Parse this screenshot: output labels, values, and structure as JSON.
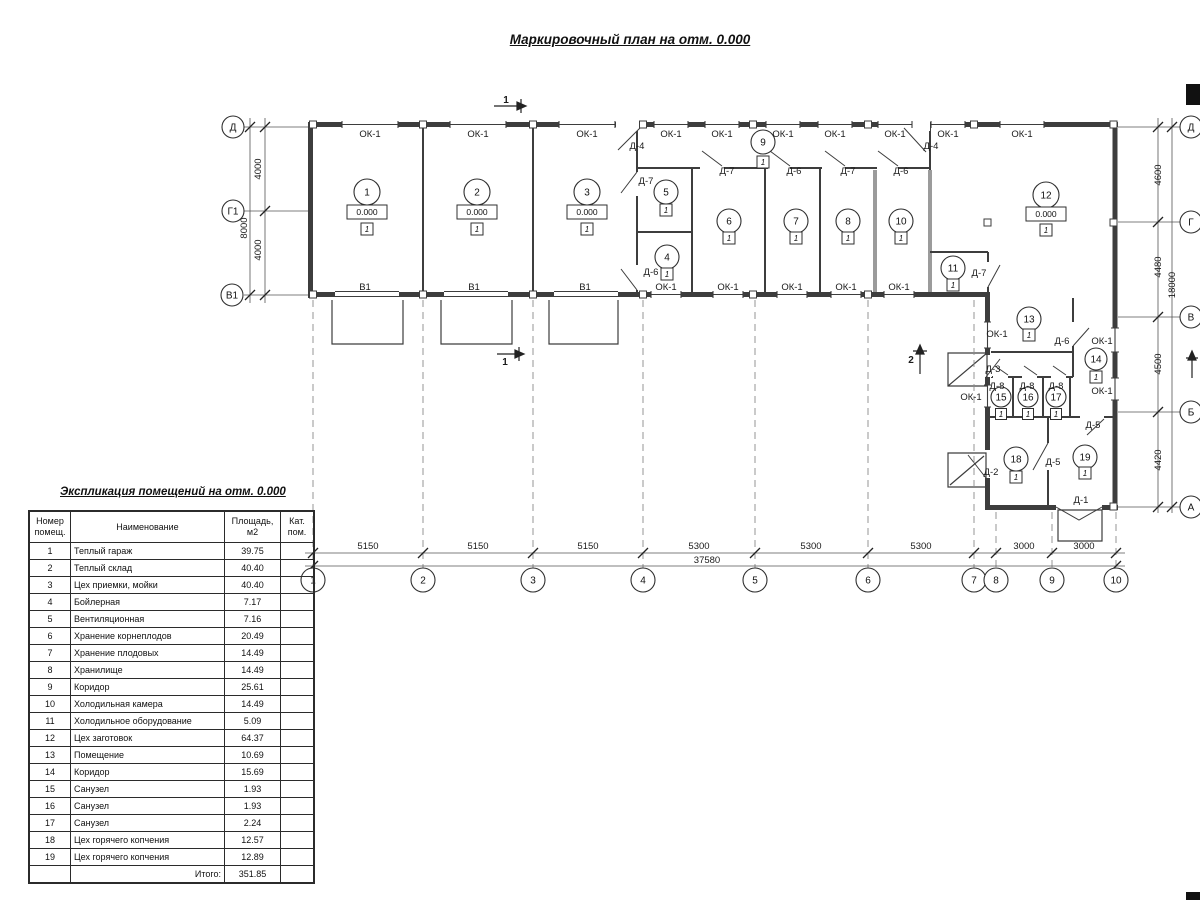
{
  "title": "Маркировочный план на отм. 0.000",
  "explication": {
    "title": "Экспликация помещений на отм. 0.000",
    "headers": [
      "Номер\nпомещ.",
      "Наименование",
      "Площадь,\nм2",
      "Кат.\nпом."
    ],
    "rows": [
      [
        "1",
        "Теплый гараж",
        "39.75",
        ""
      ],
      [
        "2",
        "Теплый склад",
        "40.40",
        ""
      ],
      [
        "3",
        "Цех приемки, мойки",
        "40.40",
        ""
      ],
      [
        "4",
        "Бойлерная",
        "7.17",
        ""
      ],
      [
        "5",
        "Вентиляционная",
        "7.16",
        ""
      ],
      [
        "6",
        "Хранение корнеплодов",
        "20.49",
        ""
      ],
      [
        "7",
        "Хранение плодовых",
        "14.49",
        ""
      ],
      [
        "8",
        "Хранилище",
        "14.49",
        ""
      ],
      [
        "9",
        "Коридор",
        "25.61",
        ""
      ],
      [
        "10",
        "Холодильная камера",
        "14.49",
        ""
      ],
      [
        "11",
        "Холодильное оборудование",
        "5.09",
        ""
      ],
      [
        "12",
        "Цех заготовок",
        "64.37",
        ""
      ],
      [
        "13",
        "Помещение",
        "10.69",
        ""
      ],
      [
        "14",
        "Коридор",
        "15.69",
        ""
      ],
      [
        "15",
        "Санузел",
        "1.93",
        ""
      ],
      [
        "16",
        "Санузел",
        "1.93",
        ""
      ],
      [
        "17",
        "Санузел",
        "2.24",
        ""
      ],
      [
        "18",
        "Цех горячего копчения",
        "12.57",
        ""
      ],
      [
        "19",
        "Цех горячего копчения",
        "12.89",
        ""
      ]
    ],
    "total_label": "Итого:",
    "total_value": "351.85"
  },
  "plan": {
    "labels": [
      {
        "t": "ОК-1",
        "x": 370,
        "y": 137,
        "n": "window-mark"
      },
      {
        "t": "ОК-1",
        "x": 478,
        "y": 137,
        "n": "window-mark"
      },
      {
        "t": "ОК-1",
        "x": 587,
        "y": 137,
        "n": "window-mark"
      },
      {
        "t": "ОК-1",
        "x": 671,
        "y": 137,
        "n": "window-mark"
      },
      {
        "t": "ОК-1",
        "x": 722,
        "y": 137,
        "n": "window-mark"
      },
      {
        "t": "ОК-1",
        "x": 783,
        "y": 137,
        "n": "window-mark"
      },
      {
        "t": "ОК-1",
        "x": 835,
        "y": 137,
        "n": "window-mark"
      },
      {
        "t": "ОК-1",
        "x": 895,
        "y": 137,
        "n": "window-mark"
      },
      {
        "t": "ОК-1",
        "x": 948,
        "y": 137,
        "n": "window-mark"
      },
      {
        "t": "ОК-1",
        "x": 1022,
        "y": 137,
        "n": "window-mark"
      },
      {
        "t": "В1",
        "x": 365,
        "y": 290,
        "n": "gate-mark"
      },
      {
        "t": "В1",
        "x": 474,
        "y": 290,
        "n": "gate-mark"
      },
      {
        "t": "В1",
        "x": 585,
        "y": 290,
        "n": "gate-mark"
      },
      {
        "t": "ОК-1",
        "x": 666,
        "y": 290,
        "n": "window-mark"
      },
      {
        "t": "ОК-1",
        "x": 728,
        "y": 290,
        "n": "window-mark"
      },
      {
        "t": "ОК-1",
        "x": 792,
        "y": 290,
        "n": "window-mark"
      },
      {
        "t": "ОК-1",
        "x": 846,
        "y": 290,
        "n": "window-mark"
      },
      {
        "t": "ОК-1",
        "x": 899,
        "y": 290,
        "n": "window-mark"
      },
      {
        "t": "ОК-1",
        "x": 997,
        "y": 337,
        "n": "window-mark"
      },
      {
        "t": "ОК-1",
        "x": 1102,
        "y": 344,
        "n": "window-mark"
      },
      {
        "t": "ОК-1",
        "x": 971,
        "y": 400,
        "n": "window-mark"
      },
      {
        "t": "ОК-1",
        "x": 1102,
        "y": 394,
        "n": "window-mark"
      },
      {
        "t": "Д-4",
        "x": 637,
        "y": 149,
        "n": "door-mark"
      },
      {
        "t": "Д-4",
        "x": 931,
        "y": 149,
        "n": "door-mark"
      },
      {
        "t": "Д-7",
        "x": 646,
        "y": 184,
        "n": "door-mark"
      },
      {
        "t": "Д-7",
        "x": 727,
        "y": 174,
        "n": "door-mark"
      },
      {
        "t": "Д-6",
        "x": 794,
        "y": 174,
        "n": "door-mark"
      },
      {
        "t": "Д-7",
        "x": 848,
        "y": 174,
        "n": "door-mark"
      },
      {
        "t": "Д-6",
        "x": 901,
        "y": 174,
        "n": "door-mark"
      },
      {
        "t": "Д-6",
        "x": 651,
        "y": 275,
        "n": "door-mark"
      },
      {
        "t": "Д-7",
        "x": 979,
        "y": 276,
        "n": "door-mark"
      },
      {
        "t": "Д-6",
        "x": 1062,
        "y": 344,
        "n": "door-mark"
      },
      {
        "t": "Д-3",
        "x": 993,
        "y": 372,
        "n": "door-mark"
      },
      {
        "t": "Д-8",
        "x": 997,
        "y": 389,
        "n": "door-mark"
      },
      {
        "t": "Д-8",
        "x": 1027,
        "y": 389,
        "n": "door-mark"
      },
      {
        "t": "Д-8",
        "x": 1056,
        "y": 389,
        "n": "door-mark"
      },
      {
        "t": "Д-5",
        "x": 1093,
        "y": 428,
        "n": "door-mark"
      },
      {
        "t": "Д-5",
        "x": 1053,
        "y": 465,
        "n": "door-mark"
      },
      {
        "t": "Д-2",
        "x": 991,
        "y": 475,
        "n": "door-mark"
      },
      {
        "t": "Д-1",
        "x": 1081,
        "y": 503,
        "n": "door-mark"
      },
      {
        "t": "5150",
        "x": 368,
        "y": 549,
        "n": "dimension"
      },
      {
        "t": "5150",
        "x": 478,
        "y": 549,
        "n": "dimension"
      },
      {
        "t": "5150",
        "x": 588,
        "y": 549,
        "n": "dimension"
      },
      {
        "t": "5300",
        "x": 699,
        "y": 549,
        "n": "dimension"
      },
      {
        "t": "5300",
        "x": 811,
        "y": 549,
        "n": "dimension"
      },
      {
        "t": "5300",
        "x": 921,
        "y": 549,
        "n": "dimension"
      },
      {
        "t": "3000",
        "x": 1024,
        "y": 549,
        "n": "dimension"
      },
      {
        "t": "3000",
        "x": 1084,
        "y": 549,
        "n": "dimension"
      },
      {
        "t": "37580",
        "x": 707,
        "y": 563,
        "n": "dimension-total"
      },
      {
        "t": "4000",
        "x": 261,
        "y": 169,
        "rot": -90,
        "n": "dimension"
      },
      {
        "t": "8000",
        "x": 247,
        "y": 228,
        "rot": -90,
        "n": "dimension"
      },
      {
        "t": "4000",
        "x": 261,
        "y": 250,
        "rot": -90,
        "n": "dimension"
      },
      {
        "t": "4600",
        "x": 1161,
        "y": 175,
        "rot": -90,
        "n": "dimension"
      },
      {
        "t": "4480",
        "x": 1161,
        "y": 267,
        "rot": -90,
        "n": "dimension"
      },
      {
        "t": "18000",
        "x": 1175,
        "y": 285,
        "rot": -90,
        "n": "dimension-total"
      },
      {
        "t": "4500",
        "x": 1161,
        "y": 364,
        "rot": -90,
        "n": "dimension"
      },
      {
        "t": "4420",
        "x": 1161,
        "y": 460,
        "rot": -90,
        "n": "dimension"
      },
      {
        "t": "1",
        "x": 506,
        "y": 103,
        "cls": "sec",
        "n": "section-mark-label"
      },
      {
        "t": "1",
        "x": 505,
        "y": 365,
        "cls": "sec",
        "n": "section-mark-label"
      },
      {
        "t": "2",
        "x": 911,
        "y": 363,
        "cls": "sec",
        "n": "section-mark-label"
      }
    ],
    "bubbles": [
      {
        "t": "Д",
        "x": 233,
        "y": 127,
        "r": 11,
        "n": "axis-bubble"
      },
      {
        "t": "Г1",
        "x": 233,
        "y": 211,
        "r": 11,
        "n": "axis-bubble"
      },
      {
        "t": "В1",
        "x": 232,
        "y": 295,
        "r": 11,
        "n": "axis-bubble"
      },
      {
        "t": "Д",
        "x": 1191,
        "y": 127,
        "r": 11,
        "n": "axis-bubble"
      },
      {
        "t": "Г",
        "x": 1191,
        "y": 222,
        "r": 11,
        "n": "axis-bubble"
      },
      {
        "t": "В",
        "x": 1191,
        "y": 317,
        "r": 11,
        "n": "axis-bubble"
      },
      {
        "t": "Б",
        "x": 1191,
        "y": 412,
        "r": 11,
        "n": "axis-bubble"
      },
      {
        "t": "А",
        "x": 1191,
        "y": 507,
        "r": 11,
        "n": "axis-bubble"
      },
      {
        "t": "1",
        "x": 313,
        "y": 580,
        "r": 12,
        "n": "axis-bubble"
      },
      {
        "t": "2",
        "x": 423,
        "y": 580,
        "r": 12,
        "n": "axis-bubble"
      },
      {
        "t": "3",
        "x": 533,
        "y": 580,
        "r": 12,
        "n": "axis-bubble"
      },
      {
        "t": "4",
        "x": 643,
        "y": 580,
        "r": 12,
        "n": "axis-bubble"
      },
      {
        "t": "5",
        "x": 755,
        "y": 580,
        "r": 12,
        "n": "axis-bubble"
      },
      {
        "t": "6",
        "x": 868,
        "y": 580,
        "r": 12,
        "n": "axis-bubble"
      },
      {
        "t": "7",
        "x": 974,
        "y": 580,
        "r": 12,
        "n": "axis-bubble"
      },
      {
        "t": "8",
        "x": 996,
        "y": 580,
        "r": 12,
        "n": "axis-bubble"
      },
      {
        "t": "9",
        "x": 1052,
        "y": 580,
        "r": 12,
        "n": "axis-bubble"
      },
      {
        "t": "10",
        "x": 1116,
        "y": 580,
        "r": 12,
        "n": "axis-bubble"
      },
      {
        "t": "1",
        "x": 367,
        "y": 192,
        "r": 13,
        "n": "room-bubble"
      },
      {
        "t": "2",
        "x": 477,
        "y": 192,
        "r": 13,
        "n": "room-bubble"
      },
      {
        "t": "3",
        "x": 587,
        "y": 192,
        "r": 13,
        "n": "room-bubble"
      },
      {
        "t": "5",
        "x": 666,
        "y": 192,
        "r": 12,
        "n": "room-bubble"
      },
      {
        "t": "4",
        "x": 667,
        "y": 257,
        "r": 12,
        "n": "room-bubble"
      },
      {
        "t": "9",
        "x": 763,
        "y": 142,
        "r": 12,
        "n": "room-bubble"
      },
      {
        "t": "6",
        "x": 729,
        "y": 221,
        "r": 12,
        "n": "room-bubble"
      },
      {
        "t": "7",
        "x": 796,
        "y": 221,
        "r": 12,
        "n": "room-bubble"
      },
      {
        "t": "8",
        "x": 848,
        "y": 221,
        "r": 12,
        "n": "room-bubble"
      },
      {
        "t": "10",
        "x": 901,
        "y": 221,
        "r": 12,
        "n": "room-bubble"
      },
      {
        "t": "11",
        "x": 953,
        "y": 268,
        "r": 12,
        "n": "room-bubble"
      },
      {
        "t": "12",
        "x": 1046,
        "y": 195,
        "r": 13,
        "n": "room-bubble"
      },
      {
        "t": "13",
        "x": 1029,
        "y": 319,
        "r": 12,
        "n": "room-bubble"
      },
      {
        "t": "14",
        "x": 1096,
        "y": 359,
        "r": 11,
        "n": "room-bubble"
      },
      {
        "t": "15",
        "x": 1001,
        "y": 397,
        "r": 10,
        "n": "room-bubble"
      },
      {
        "t": "16",
        "x": 1028,
        "y": 397,
        "r": 10,
        "n": "room-bubble"
      },
      {
        "t": "17",
        "x": 1056,
        "y": 397,
        "r": 10,
        "n": "room-bubble"
      },
      {
        "t": "18",
        "x": 1016,
        "y": 459,
        "r": 12,
        "n": "room-bubble"
      },
      {
        "t": "19",
        "x": 1085,
        "y": 457,
        "r": 12,
        "n": "room-bubble"
      }
    ],
    "boxes": [
      {
        "t": "0.000",
        "x": 367,
        "y": 212,
        "w": 40,
        "h": 14,
        "cls": "bxe",
        "n": "elevation-mark"
      },
      {
        "t": "0.000",
        "x": 477,
        "y": 212,
        "w": 40,
        "h": 14,
        "cls": "bxe",
        "n": "elevation-mark"
      },
      {
        "t": "0.000",
        "x": 587,
        "y": 212,
        "w": 40,
        "h": 14,
        "cls": "bxe",
        "n": "elevation-mark"
      },
      {
        "t": "0.000",
        "x": 1046,
        "y": 214,
        "w": 40,
        "h": 14,
        "cls": "bxe",
        "n": "elevation-mark"
      },
      {
        "t": "1",
        "x": 367,
        "y": 229,
        "w": 12,
        "h": 12,
        "cls": "bxf",
        "n": "floor-type-mark"
      },
      {
        "t": "1",
        "x": 477,
        "y": 229,
        "w": 12,
        "h": 12,
        "cls": "bxf",
        "n": "floor-type-mark"
      },
      {
        "t": "1",
        "x": 587,
        "y": 229,
        "w": 12,
        "h": 12,
        "cls": "bxf",
        "n": "floor-type-mark"
      },
      {
        "t": "1",
        "x": 1046,
        "y": 230,
        "w": 12,
        "h": 12,
        "cls": "bxf",
        "n": "floor-type-mark"
      },
      {
        "t": "1",
        "x": 666,
        "y": 210,
        "w": 12,
        "h": 12,
        "cls": "bxf",
        "n": "floor-type-mark"
      },
      {
        "t": "1",
        "x": 667,
        "y": 274,
        "w": 12,
        "h": 12,
        "cls": "bxf",
        "n": "floor-type-mark"
      },
      {
        "t": "1",
        "x": 763,
        "y": 162,
        "w": 12,
        "h": 12,
        "cls": "bxf",
        "n": "floor-type-mark"
      },
      {
        "t": "1",
        "x": 729,
        "y": 238,
        "w": 12,
        "h": 12,
        "cls": "bxf",
        "n": "floor-type-mark"
      },
      {
        "t": "1",
        "x": 796,
        "y": 238,
        "w": 12,
        "h": 12,
        "cls": "bxf",
        "n": "floor-type-mark"
      },
      {
        "t": "1",
        "x": 848,
        "y": 238,
        "w": 12,
        "h": 12,
        "cls": "bxf",
        "n": "floor-type-mark"
      },
      {
        "t": "1",
        "x": 901,
        "y": 238,
        "w": 12,
        "h": 12,
        "cls": "bxf",
        "n": "floor-type-mark"
      },
      {
        "t": "1",
        "x": 953,
        "y": 285,
        "w": 12,
        "h": 12,
        "cls": "bxf",
        "n": "floor-type-mark"
      },
      {
        "t": "1",
        "x": 1029,
        "y": 335,
        "w": 12,
        "h": 12,
        "cls": "bxf",
        "n": "floor-type-mark"
      },
      {
        "t": "1",
        "x": 1096,
        "y": 377,
        "w": 12,
        "h": 12,
        "cls": "bxf",
        "n": "floor-type-mark"
      },
      {
        "t": "1",
        "x": 1001,
        "y": 414,
        "w": 11,
        "h": 11,
        "cls": "bxf",
        "n": "floor-type-mark"
      },
      {
        "t": "1",
        "x": 1028,
        "y": 414,
        "w": 11,
        "h": 11,
        "cls": "bxf",
        "n": "floor-type-mark"
      },
      {
        "t": "1",
        "x": 1056,
        "y": 414,
        "w": 11,
        "h": 11,
        "cls": "bxf",
        "n": "floor-type-mark"
      },
      {
        "t": "1",
        "x": 1016,
        "y": 477,
        "w": 12,
        "h": 12,
        "cls": "bxf",
        "n": "floor-type-mark"
      },
      {
        "t": "1",
        "x": 1085,
        "y": 473,
        "w": 12,
        "h": 12,
        "cls": "bxf",
        "n": "floor-type-mark"
      }
    ]
  }
}
